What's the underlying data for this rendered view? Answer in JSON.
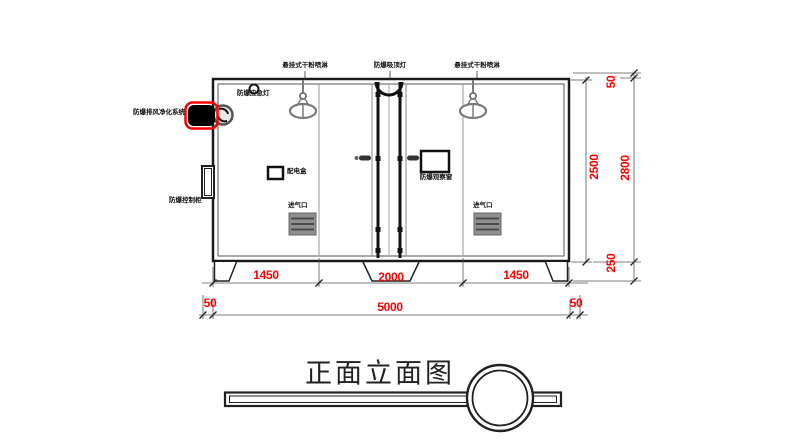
{
  "drawing": {
    "title": "正面立面图"
  },
  "equipment_labels": {
    "sprinkler_left": "悬挂式干粉喷淋",
    "ceiling_light": "防爆吸顶灯",
    "sprinkler_right": "悬挂式干粉喷淋",
    "emergency_light": "防爆应急灯",
    "exhaust_purifier": "防爆排风净化系统",
    "control_cabinet": "防爆控制柜",
    "power_box": "配电盒",
    "observation_window": "防爆观察窗",
    "air_inlet_left": "进气口",
    "air_inlet_right": "进气口"
  },
  "dimensions": {
    "width_segments": [
      "1450",
      "2000",
      "1450"
    ],
    "total_width": "5000",
    "width_left_offset": "50",
    "width_right_offset": "50",
    "inner_height": "2500",
    "total_height": "2800",
    "top_offset": "50",
    "base_height": "250"
  },
  "colors": {
    "dimension_text": "#FF0000",
    "highlight": "#FF0000",
    "linework": "#1A1A1A",
    "secondary_linework": "#808080"
  }
}
